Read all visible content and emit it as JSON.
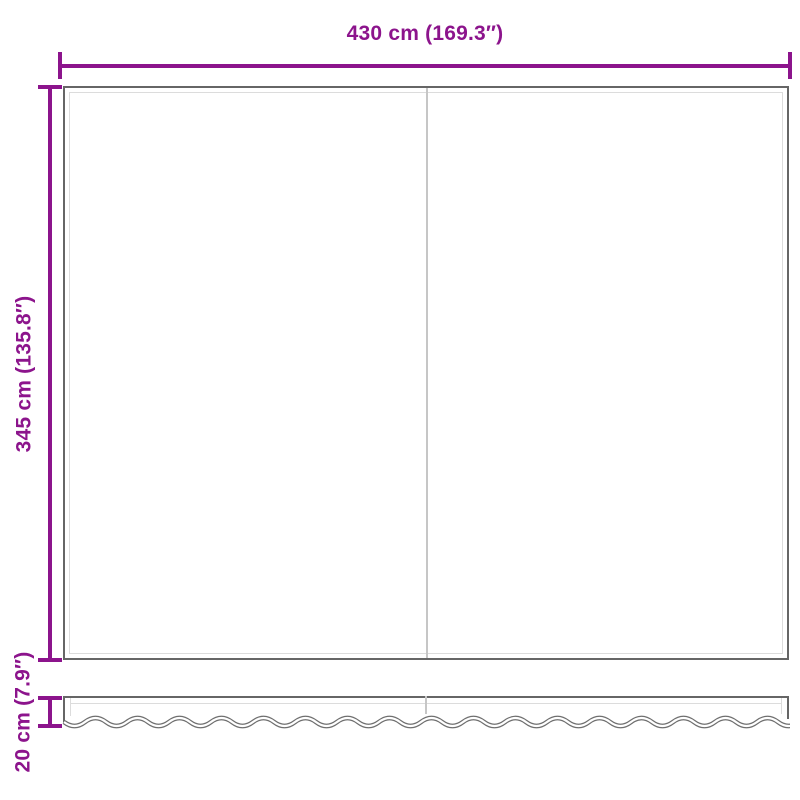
{
  "diagram": {
    "type": "product-dimension-diagram",
    "subject": "awning replacement fabric with wavy valance",
    "dimensions": {
      "width_label": "430 cm (169.3″)",
      "height_label": "345 cm (135.8″)",
      "valance_height_label": "20 cm (7.9″)"
    },
    "colors": {
      "dimension_accent": "#8c148c",
      "outline_gray": "#666666",
      "inner_hem_gray": "#dcdcdc",
      "seam_gray": "#c6c6c6",
      "background": "#ffffff"
    }
  }
}
